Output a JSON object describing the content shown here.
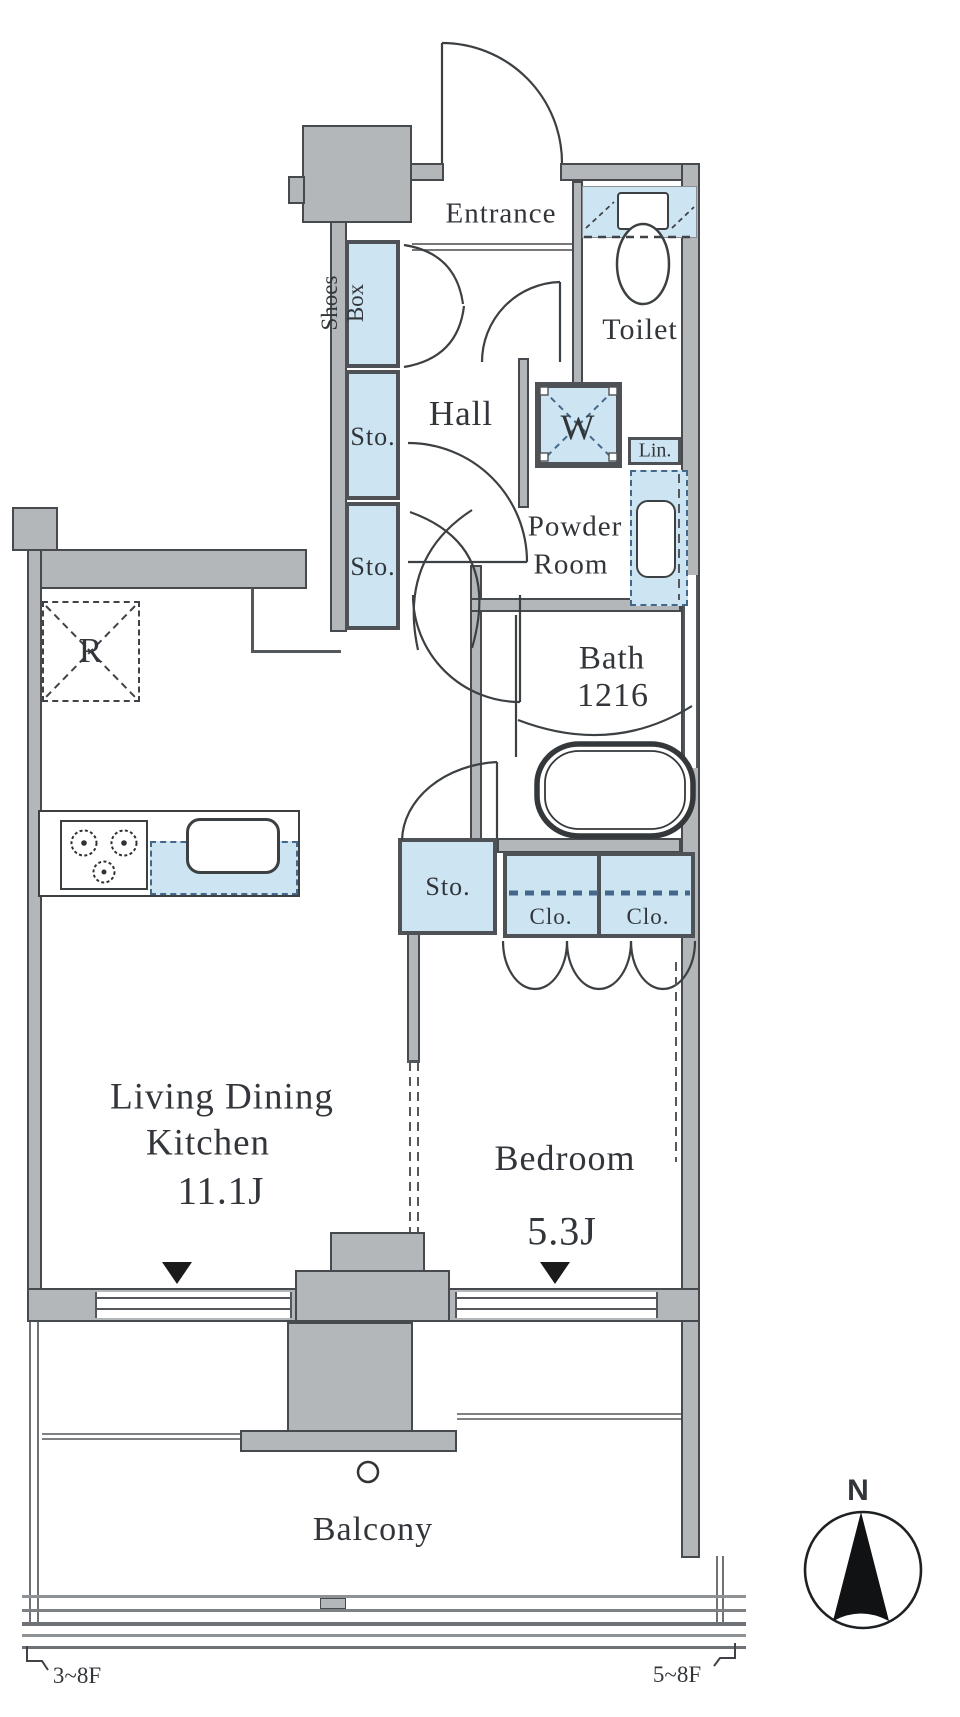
{
  "rooms": {
    "entrance": "Entrance",
    "toilet": "Toilet",
    "hall": "Hall",
    "powder_line1": "Powder",
    "powder_line2": "Room",
    "bath": "Bath",
    "bath_size": "1216",
    "ldk_line1": "Living Dining",
    "ldk_line2": "Kitchen",
    "ldk_size": "11.1J",
    "bedroom": "Bedroom",
    "bedroom_size": "5.3J",
    "balcony": "Balcony"
  },
  "storage": {
    "shoes_line1": "Shoes",
    "shoes_line2": "Box",
    "sto_hall_upper": "Sto.",
    "sto_hall_lower": "Sto.",
    "sto_bedroom": "Sto.",
    "clo_left": "Clo.",
    "clo_right": "Clo.",
    "linen": "Lin."
  },
  "fixtures": {
    "washer": "W",
    "refrigerator": "R"
  },
  "annotations": {
    "floor_left": "3~8F",
    "floor_right": "5~8F",
    "compass_north": "N"
  },
  "colors": {
    "fixture_blue": "#cde5f2",
    "wall_gray": "#b4b7b9",
    "wall_edge": "#46494d",
    "line_dark": "#3c4043",
    "dash_blue": "#44688a",
    "text": "#32363a"
  }
}
